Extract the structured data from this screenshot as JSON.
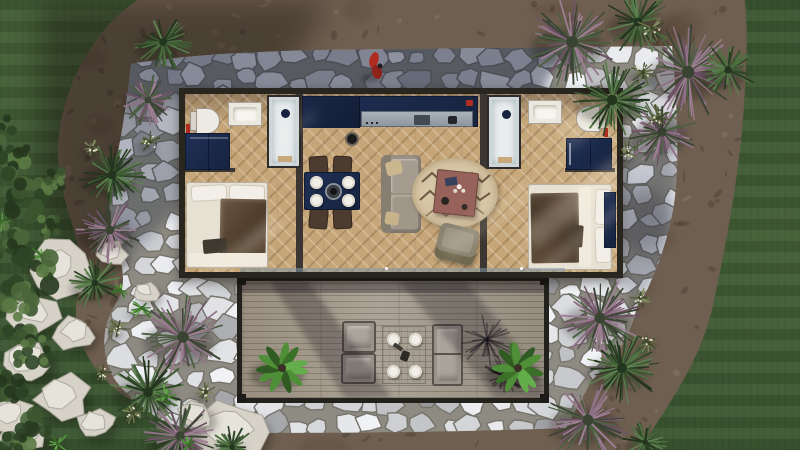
{
  "scene": {
    "title": "Top-down aerial 3D render of a rectangular container-style tiny home with two mirrored bedroom/bathroom suites, central kitchen-living room, rear stone patio, front wooden deck and xeriscaped yard",
    "view": "orthographic top-down",
    "time_of_day": "sunny with hard diagonal shadows"
  },
  "colors": {
    "grass": "#3a5530",
    "grassDark": "#273c22",
    "dirt": "#6f5f50",
    "dirtDark": "#3f332a",
    "stoneBase": "#8d8b82",
    "stoneGap": "#75736a",
    "shadowTint": "#1d2336",
    "frame": "#29261f",
    "wall": "#3b3631",
    "floor": "#c6a678",
    "navy": "#1f2f55",
    "navyDark": "#17233f",
    "bedWhite": "#e7e1d4",
    "blanket": "#5c4733",
    "sofa": "#9b9286",
    "pillowTan": "#cbb78f",
    "rug": "#d8c7a6",
    "rugLine": "#6d5944",
    "coffee": "#96625a",
    "chairBrown": "#4c3b2f",
    "deckWood": "#a29a8c",
    "deckFrame": "#23211c",
    "steel": "#9aa3ac",
    "red": "#b12d22",
    "rock": "#d6d2c8",
    "shower": "#cfd6d9"
  },
  "house": {
    "rooms": [
      {
        "name": "left-bathroom",
        "fixtures": [
          "toilet",
          "vanity-sink",
          "walk-in-shower",
          "navy-washer-cabinet",
          "red-towel"
        ]
      },
      {
        "name": "left-bedroom",
        "fixtures": [
          "double-bed-white-linen-brown-throw",
          "foot-bench"
        ]
      },
      {
        "name": "kitchen-living-room",
        "fixtures": [
          "navy-kitchen-counter-with-steel-cooktop",
          "navy-dining-table-4-white-plates",
          "4-dark-chairs",
          "grey-sofa-2-tan-pillows",
          "round-berber-rug",
          "rust-coffee-table-with-flowers",
          "olive-armchair",
          "black-stool"
        ]
      },
      {
        "name": "right-bathroom",
        "fixtures": [
          "walk-in-shower",
          "vanity-sink",
          "toilet",
          "navy-cabinet",
          "red-towel"
        ]
      },
      {
        "name": "right-bedroom",
        "fixtures": [
          "double-bed-white-linen-brown-throw",
          "navy-wardrobe"
        ]
      }
    ],
    "floor": "herringbone oak",
    "north_window_count": 4
  },
  "deck": {
    "material": "grey wood planks",
    "furniture": [
      "lounge-chair",
      "lounge-chair",
      "plank-table-4-white-plates",
      "outdoor-sofa-bench",
      "potted-plant",
      "potted-plant"
    ]
  },
  "accents": {
    "red_figure": {
      "x": 374,
      "y": 64,
      "note": "red jacket object on upper patio"
    }
  },
  "landscape": {
    "yuccas": [
      {
        "x": 572,
        "y": 42,
        "r": 46,
        "t": "purple"
      },
      {
        "x": 638,
        "y": 22,
        "r": 34,
        "t": "green"
      },
      {
        "x": 688,
        "y": 72,
        "r": 48,
        "t": "purple"
      },
      {
        "x": 612,
        "y": 100,
        "r": 40,
        "t": "green"
      },
      {
        "x": 662,
        "y": 132,
        "r": 36,
        "t": "purple"
      },
      {
        "x": 728,
        "y": 70,
        "r": 28,
        "t": "green"
      },
      {
        "x": 163,
        "y": 42,
        "r": 30,
        "t": "green"
      },
      {
        "x": 148,
        "y": 100,
        "r": 26,
        "t": "purple"
      },
      {
        "x": 112,
        "y": 175,
        "r": 34,
        "t": "green"
      },
      {
        "x": 110,
        "y": 230,
        "r": 34,
        "t": "purple"
      },
      {
        "x": 95,
        "y": 283,
        "r": 26,
        "t": "green"
      },
      {
        "x": 183,
        "y": 337,
        "r": 44,
        "t": "purple"
      },
      {
        "x": 148,
        "y": 392,
        "r": 38,
        "t": "green"
      },
      {
        "x": 180,
        "y": 436,
        "r": 36,
        "t": "purple"
      },
      {
        "x": 232,
        "y": 447,
        "r": 22,
        "t": "green"
      },
      {
        "x": 600,
        "y": 318,
        "r": 42,
        "t": "purple"
      },
      {
        "x": 622,
        "y": 368,
        "r": 38,
        "t": "green"
      },
      {
        "x": 588,
        "y": 420,
        "r": 42,
        "t": "purple"
      },
      {
        "x": 645,
        "y": 442,
        "r": 22,
        "t": "green"
      }
    ],
    "tufts": [
      {
        "x": 652,
        "y": 28,
        "r": 15
      },
      {
        "x": 643,
        "y": 72,
        "r": 13
      },
      {
        "x": 658,
        "y": 118,
        "r": 14
      },
      {
        "x": 628,
        "y": 152,
        "r": 11
      },
      {
        "x": 118,
        "y": 328,
        "r": 12
      },
      {
        "x": 102,
        "y": 372,
        "r": 10
      },
      {
        "x": 133,
        "y": 413,
        "r": 11
      },
      {
        "x": 640,
        "y": 298,
        "r": 11
      },
      {
        "x": 648,
        "y": 343,
        "r": 11
      },
      {
        "x": 150,
        "y": 142,
        "r": 11
      },
      {
        "x": 92,
        "y": 148,
        "r": 9
      },
      {
        "x": 206,
        "y": 392,
        "r": 10
      }
    ],
    "bushes": [
      {
        "x": 10,
        "y": 158,
        "r": 20
      },
      {
        "x": 24,
        "y": 198,
        "r": 24
      },
      {
        "x": 8,
        "y": 240,
        "r": 22
      },
      {
        "x": 30,
        "y": 278,
        "r": 26
      },
      {
        "x": 14,
        "y": 318,
        "r": 22
      },
      {
        "x": 34,
        "y": 350,
        "r": 20
      },
      {
        "x": 10,
        "y": 386,
        "r": 18
      },
      {
        "x": 28,
        "y": 428,
        "r": 22
      },
      {
        "x": 6,
        "y": 448,
        "r": 16
      },
      {
        "x": 52,
        "y": 182,
        "r": 13
      },
      {
        "x": 48,
        "y": 228,
        "r": 12
      },
      {
        "x": 0,
        "y": 130,
        "r": 14
      }
    ],
    "agaves": [
      {
        "x": 42,
        "y": 256,
        "r": 14
      },
      {
        "x": 14,
        "y": 300,
        "r": 12
      },
      {
        "x": 142,
        "y": 308,
        "r": 13
      },
      {
        "x": 166,
        "y": 396,
        "r": 12
      },
      {
        "x": 58,
        "y": 444,
        "r": 12
      },
      {
        "x": 188,
        "y": 445,
        "r": 10
      },
      {
        "x": 2,
        "y": 222,
        "r": 10
      },
      {
        "x": 120,
        "y": 290,
        "r": 9
      }
    ],
    "rocks": [
      {
        "x": 57,
        "y": 268,
        "r": 34
      },
      {
        "x": 33,
        "y": 314,
        "r": 25
      },
      {
        "x": 76,
        "y": 334,
        "r": 20
      },
      {
        "x": 28,
        "y": 362,
        "r": 27
      },
      {
        "x": 62,
        "y": 398,
        "r": 28
      },
      {
        "x": 24,
        "y": 434,
        "r": 24
      },
      {
        "x": 96,
        "y": 424,
        "r": 19
      },
      {
        "x": 112,
        "y": 254,
        "r": 16
      },
      {
        "x": 146,
        "y": 292,
        "r": 13
      },
      {
        "x": 232,
        "y": 432,
        "r": 38
      },
      {
        "x": 196,
        "y": 416,
        "r": 18
      },
      {
        "x": 10,
        "y": 415,
        "r": 22
      }
    ],
    "deck_plants": [
      {
        "x": 282,
        "y": 368,
        "r": 27
      },
      {
        "x": 518,
        "y": 368,
        "r": 27
      }
    ]
  }
}
